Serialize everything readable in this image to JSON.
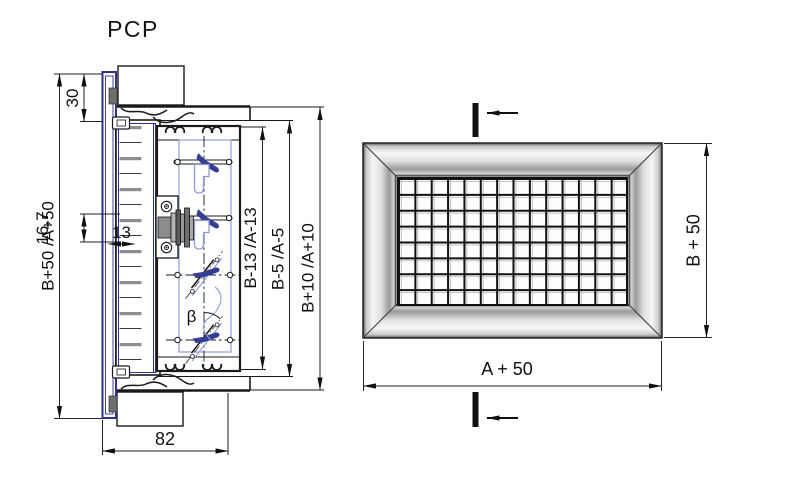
{
  "title": "PCP",
  "drawing": {
    "type": "technical-drawing",
    "views": {
      "section": {
        "name": "Section view",
        "labels": {
          "overall_height": "B+50 /A+50",
          "frame_margin": "30",
          "slat_pitch": "16,7",
          "slat_opening": "13",
          "duct_size": "B-13 /A-13",
          "inner_size": "B-5 /A-5",
          "outer_size": "B+10 /A+10",
          "depth": "82",
          "blade_angle": "β"
        }
      },
      "front": {
        "name": "Front view",
        "labels": {
          "width": "A + 50",
          "height": "B + 50"
        }
      }
    },
    "colors": {
      "frame_blue": "#2e3192",
      "blade_blue": "#333d94",
      "profile_light_blue": "#8d9cd6",
      "line_black": "#1a1a1a"
    }
  }
}
